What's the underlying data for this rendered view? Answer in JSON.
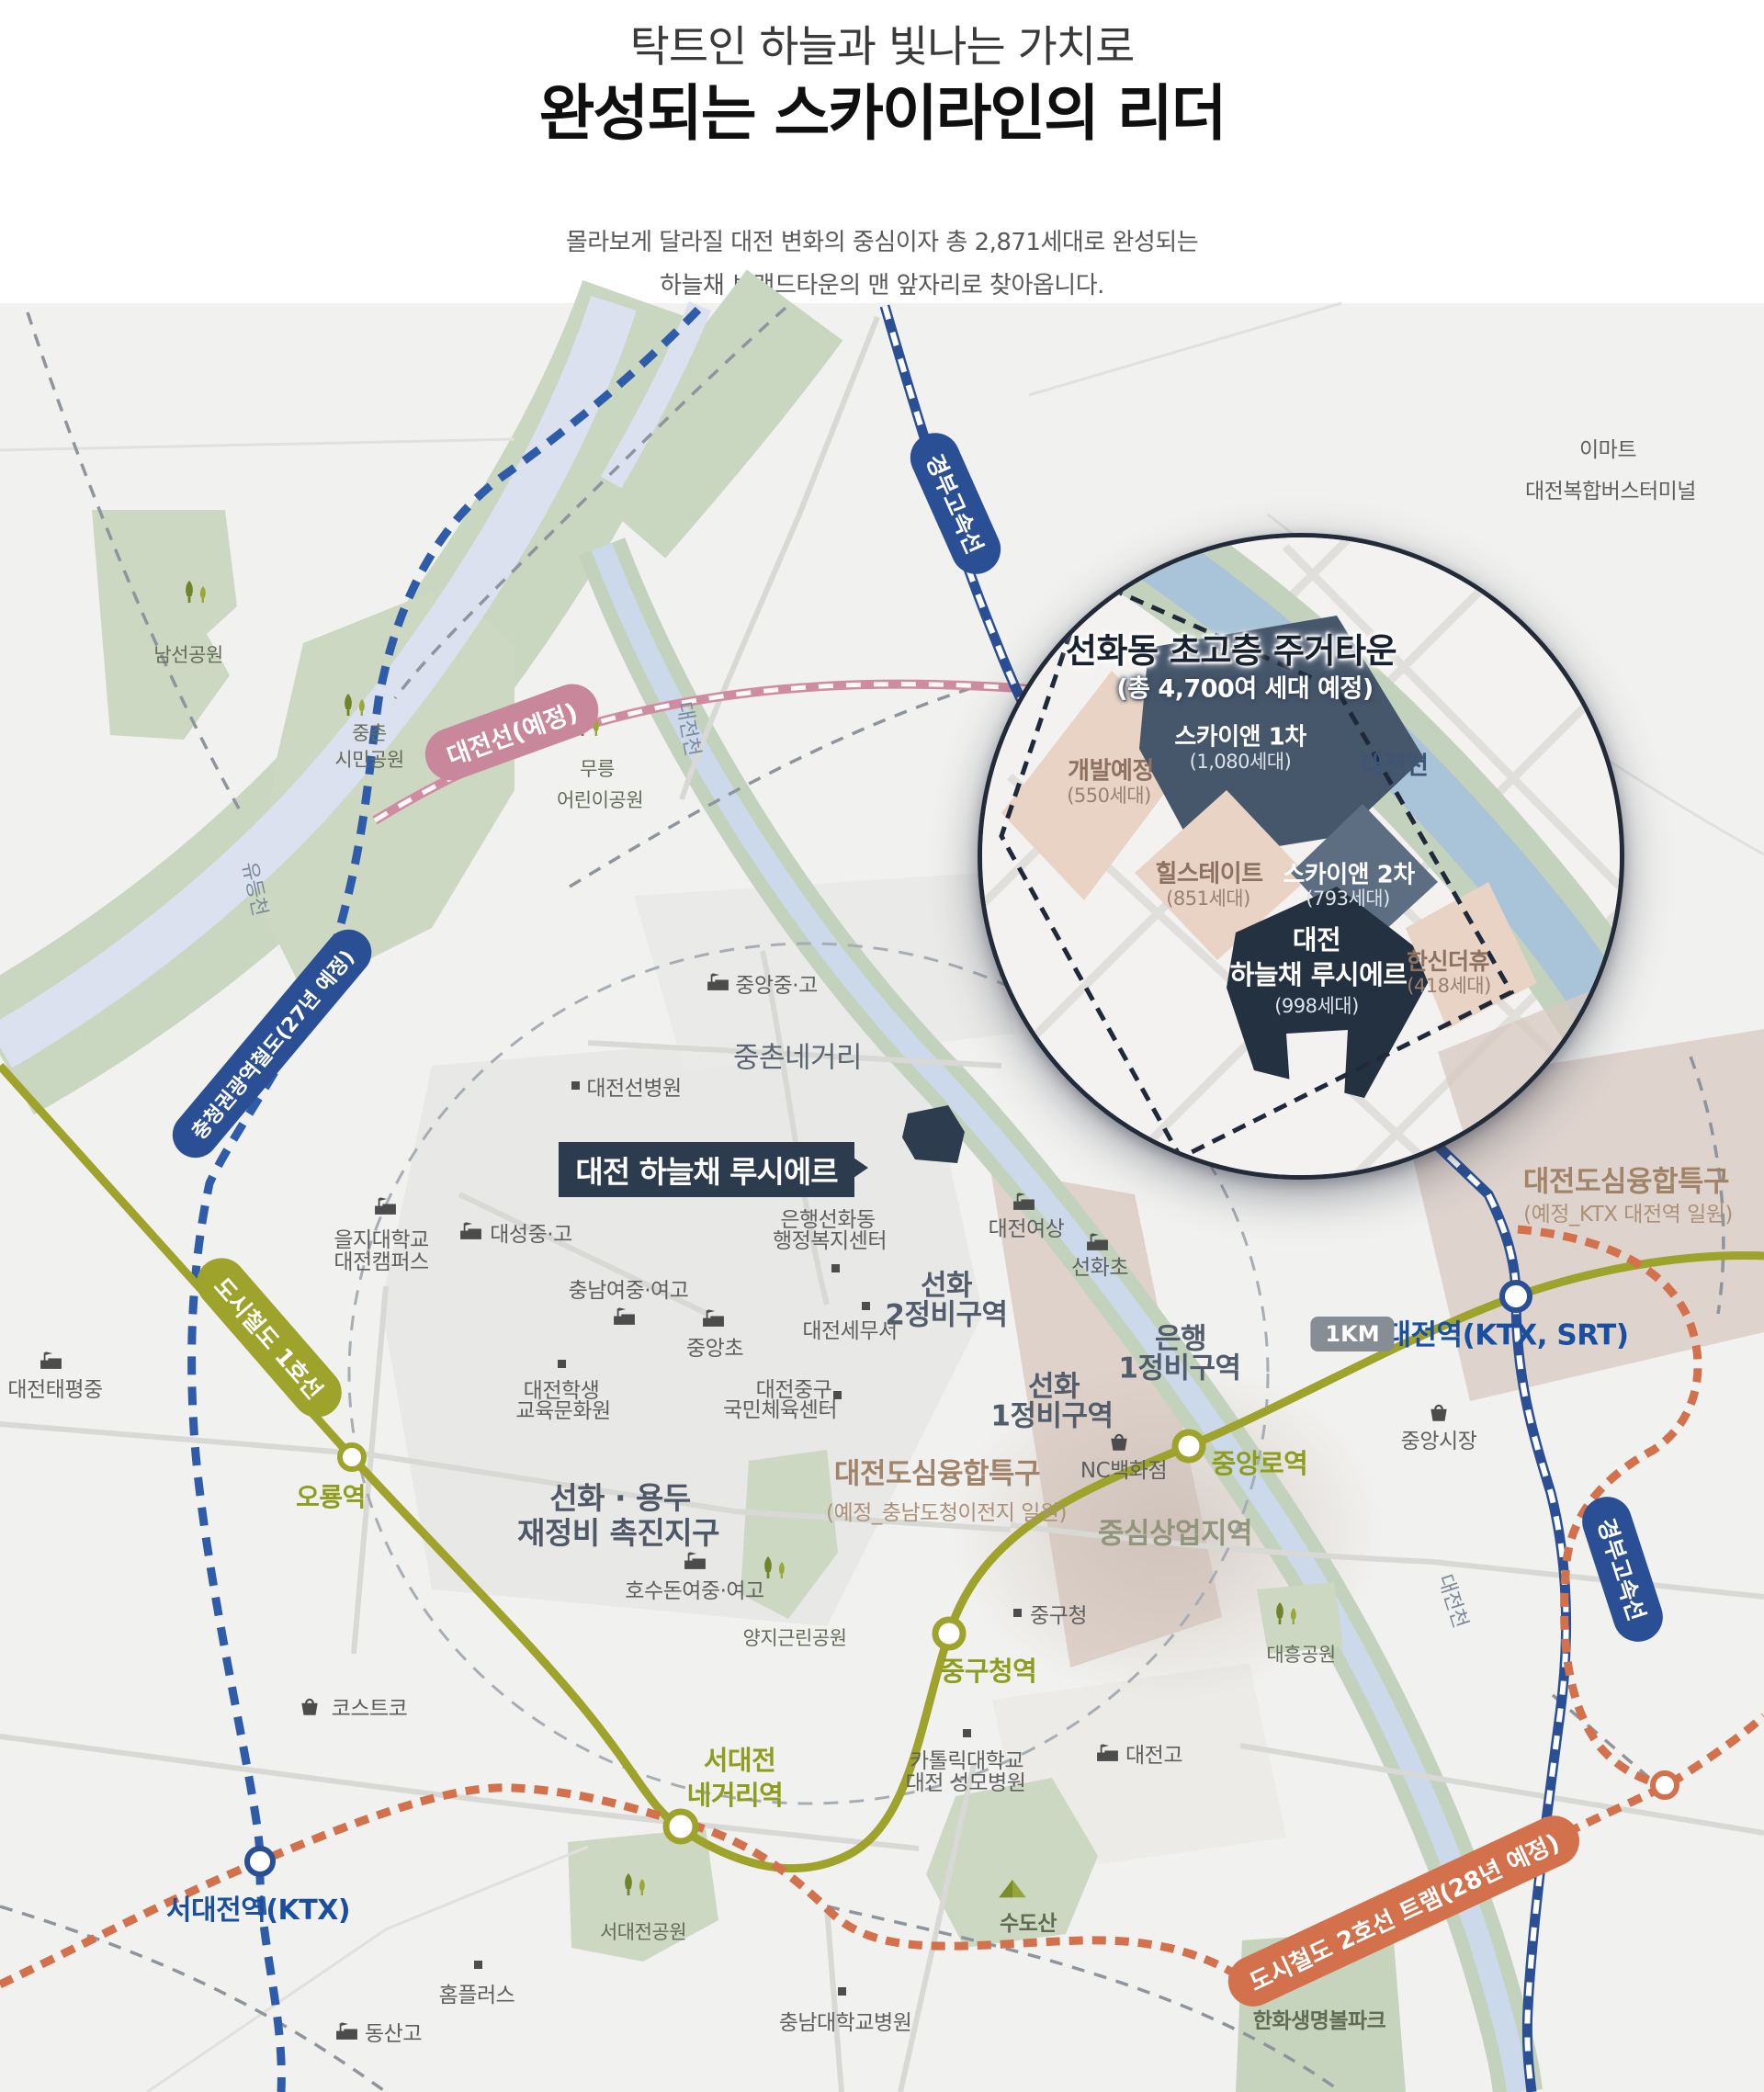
{
  "header": {
    "title_line1": "탁트인 하늘과 빛나는 가치로",
    "title_line2": "완성되는 스카이라인의 리더",
    "subtitle_line1": "몰라보게 달라질 대전 변화의 중심이자 총 2,871세대로 완성되는",
    "subtitle_line2": "하늘채 브랜드타운의 맨 앞자리로 찾아옵니다."
  },
  "callout": {
    "label": "대전 하늘채 루시에르"
  },
  "inset": {
    "title": "선화동 초고층 주거타운",
    "subtitle": "(총 4,700여 세대 예정)",
    "river": "대전천",
    "blocks": {
      "dev": {
        "name": "개발예정",
        "units": "(550세대)"
      },
      "sky1": {
        "name": "스카이앤 1차",
        "units": "(1,080세대)"
      },
      "hill": {
        "name": "힐스테이트",
        "units": "(851세대)"
      },
      "sky2": {
        "name": "스카이앤 2차",
        "units": "(793세대)"
      },
      "lucierre": {
        "name": "대전",
        "name2": "하늘채 루시에르",
        "units": "(998세대)"
      },
      "hanshin": {
        "name": "한신더휴",
        "units": "(418세대)"
      }
    }
  },
  "badges": {
    "gyeongbu_top": "경부고속선",
    "gyeongbu_right": "경부고속선",
    "daejeon_line": "대전선(예정)",
    "chungcheong_rail": "충청권광역철도(27년 예정)",
    "metro_line1": "도시철도 1호선",
    "tram_line2": "도시철도 2호선 트램(28년 예정)",
    "distance": "1KM"
  },
  "stations": {
    "oryong": "오룡역",
    "seodaejeon_negeori_1": "서대전",
    "seodaejeon_negeori_2": "네거리역",
    "junggucheong": "중구청역",
    "jungangno": "중앙로역",
    "daejeon": "대전역(KTX, SRT)",
    "seodaejeon_ktx": "서대전역(KTX)"
  },
  "areas": {
    "jungchon_negeori": "중촌네거리",
    "seonhwa2_1": "선화",
    "seonhwa2_2": "2정비구역",
    "seonhwa1_1": "선화",
    "seonhwa1_2": "1정비구역",
    "eunhaeng1_1": "은행",
    "eunhaeng1_2": "1정비구역",
    "seonhwa_yongdu_1": "선화 · 용두",
    "seonhwa_yongdu_2": "재정비 촉진지구",
    "central_commercial": "중심상업지역",
    "special1": "대전도심융합특구",
    "special1_sub": "(예정_충남도청이전지 일원)",
    "special2": "대전도심융합특구",
    "special2_sub": "(예정_KTX 대전역 일원)"
  },
  "parks": {
    "namseon": "남선공원",
    "jungchon1": "중촌",
    "jungchon2": "시민공원",
    "mureung1": "무릉",
    "mureung2": "어린이공원",
    "yangji": "양지근린공원",
    "seodaejeon": "서대전공원",
    "daeheung": "대흥공원",
    "sudosan": "수도산",
    "hanwha": "한화생명볼파크"
  },
  "rivers": {
    "yudeung": "유등천",
    "daejeon_a": "대전천",
    "daejeon_b": "대전천"
  },
  "pois": {
    "emart": "이마트",
    "bus_terminal": "대전복합버스터미널",
    "jungang_mhs": "중앙중·고",
    "daejeon_sun_hospital": "대전선병원",
    "daeseong": "대성중·고",
    "eulji1": "을지대학교",
    "eulji2": "대전캠퍼스",
    "taepyeong": "대전태평중",
    "chungnam_girls": "충남여중·여고",
    "jungang_elem": "중앙초",
    "student1": "대전학생",
    "student2": "교육문화원",
    "tax_office": "대전세무서",
    "sports1": "대전중구",
    "sports2": "국민체육센터",
    "daejeon_girls": "대전여상",
    "seonhwa_elem": "선화초",
    "haengbok1": "은행선화동",
    "haengbok2": "행정복지센터",
    "nc": "NC백화점",
    "jungang_market": "중앙시장",
    "hosudon": "호수돈여중·여고",
    "gu_office": "중구청",
    "catholic1": "카톨릭대학교",
    "catholic2": "대전 성모병원",
    "daejeon_high": "대전고",
    "costco": "코스트코",
    "homeplus": "홈플러스",
    "chungnam_univ_hosp": "충남대학교병원",
    "dongsan": "동산고"
  },
  "colors": {
    "metro_line1": "#9da32b",
    "ktx_rail": "#2a4f94",
    "tram_line2": "#d2714b",
    "daejeon_line": "#c9879c",
    "site_block": "#233140",
    "dark_block": "#46566b",
    "beige_block": "#e9d3c4"
  }
}
